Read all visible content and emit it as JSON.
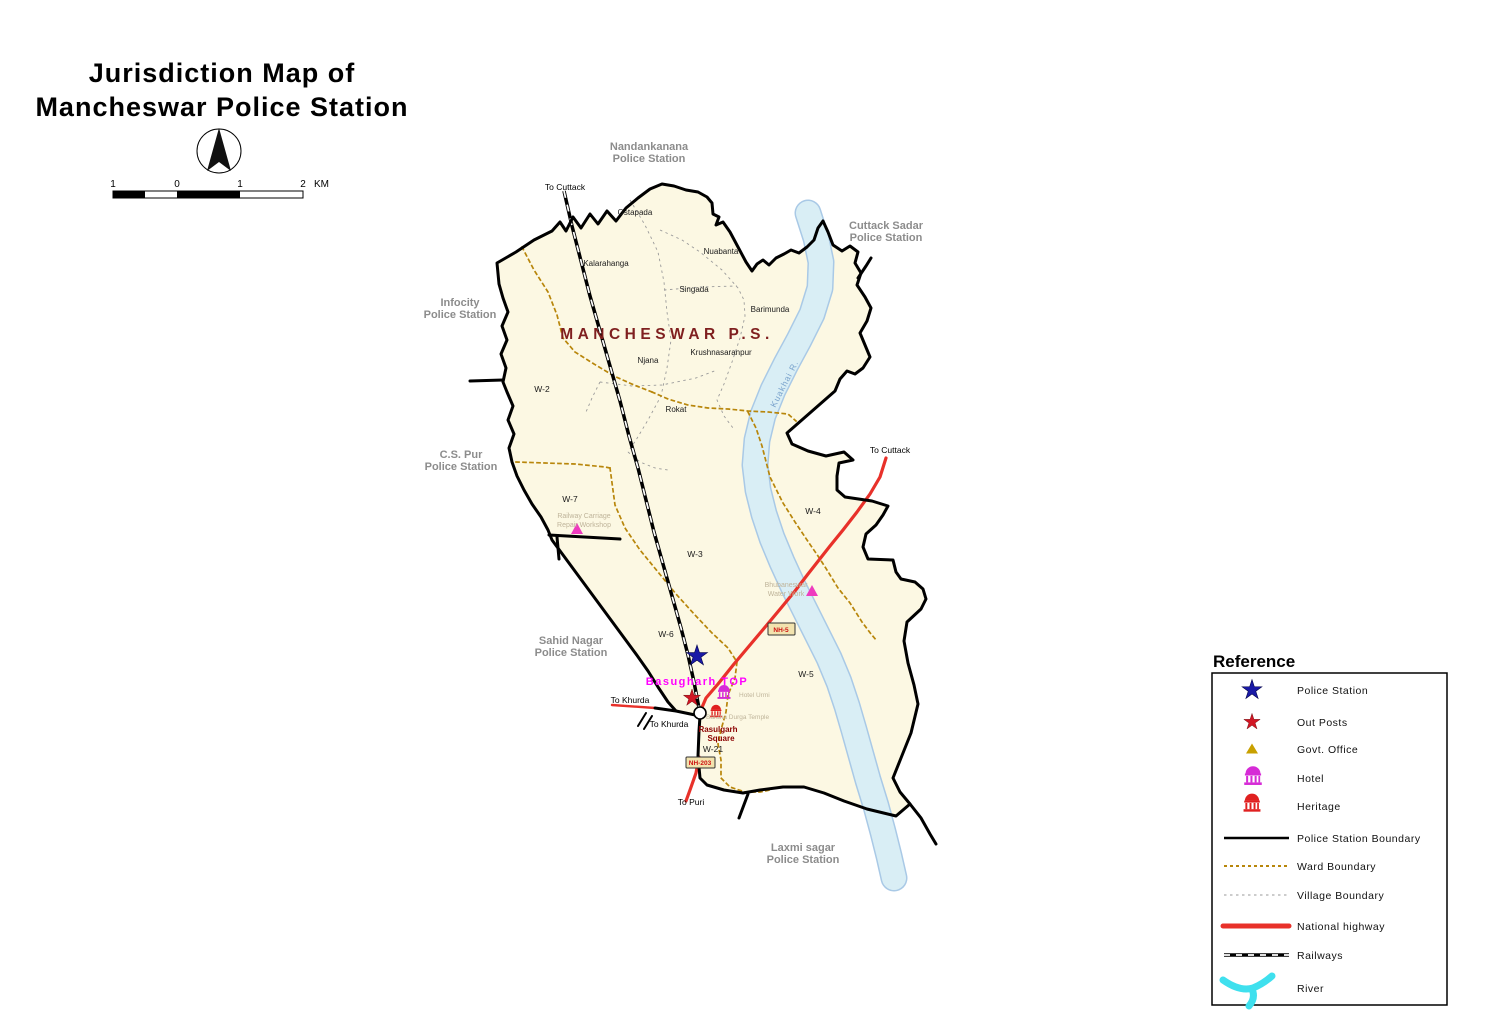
{
  "header": {
    "title_line1": "Jurisdiction Map of",
    "title_line2": "Mancheswar Police Station"
  },
  "scale_bar": {
    "ticks": [
      "1",
      "0",
      "1",
      "2"
    ],
    "unit": "KM"
  },
  "map": {
    "ps_label": "MANCHESWAR P.S.",
    "neighbors": {
      "nandankanana": [
        "Nandankanana",
        "Police Station"
      ],
      "cuttack_sadar": [
        "Cuttack Sadar",
        "Police Station"
      ],
      "infocity": [
        "Infocity",
        "Police Station"
      ],
      "cs_pur": [
        "C.S. Pur",
        "Police Station"
      ],
      "sahid_nagar": [
        "Sahid Nagar",
        "Police Station"
      ],
      "laxmi_sagar": [
        "Laxmi sagar",
        "Police Station"
      ]
    },
    "villages": [
      "Ostapada",
      "Kalarahanga",
      "Nuabanta",
      "Singada",
      "Barimunda",
      "Krushnasaranpur",
      "Njana",
      "Rokat"
    ],
    "wards": [
      "W-2",
      "W-7",
      "W-3",
      "W-4",
      "W-6",
      "W-5",
      "W-21"
    ],
    "road_labels": {
      "to_cuttack_north": "To Cuttack",
      "to_cuttack_east": "To Cuttack",
      "to_khurda_a": "To Khurda",
      "to_khurda_b": "To Khurda",
      "to_puri": "To Puri"
    },
    "highway_badges": {
      "nh5": "NH-5",
      "nh203": "NH-203"
    },
    "river_label": "Kuakhai R.",
    "pois": {
      "basugharh_top": "Basugharh TOP",
      "rasulgarh_square": [
        "Rasulgarh",
        "Square"
      ],
      "hotel": "Hotel Urmi",
      "temple": "Baraha Durga Temple",
      "workshop": [
        "Railway Carriage",
        "Repair Workshop"
      ],
      "waterwork": [
        "Bhubaneswar",
        "Water Work"
      ]
    }
  },
  "legend": {
    "title": "Reference",
    "items": [
      "Police Station",
      "Out Posts",
      "Govt. Office",
      "Hotel",
      "Heritage",
      "Police Station Boundary",
      "Ward Boundary",
      "Village Boundary",
      "National highway",
      "Railways",
      "River"
    ]
  },
  "colors": {
    "map_fill": "#FCF8E3",
    "river_fill": "#D9EEF5",
    "river_edge": "#A9C9E6",
    "police_station_boundary": "#000000",
    "ward_boundary": "#B8860B",
    "village_boundary": "#9A9A9A",
    "national_highway": "#E8312A",
    "police_station_star": "#1A1AA6",
    "out_post_star": "#D11624",
    "govt_office_triangle": "#C8A000",
    "map_triangle": "#EE3BBE",
    "hotel_icon": "#D62BD6",
    "heritage_icon": "#E02020",
    "ps_name_text": "#7F1F1F",
    "neighbor_text": "#8C8C8C",
    "poi_text": "#BFB49A",
    "top_text": "#FF00FF",
    "river_legend": "#3FE0EE"
  }
}
